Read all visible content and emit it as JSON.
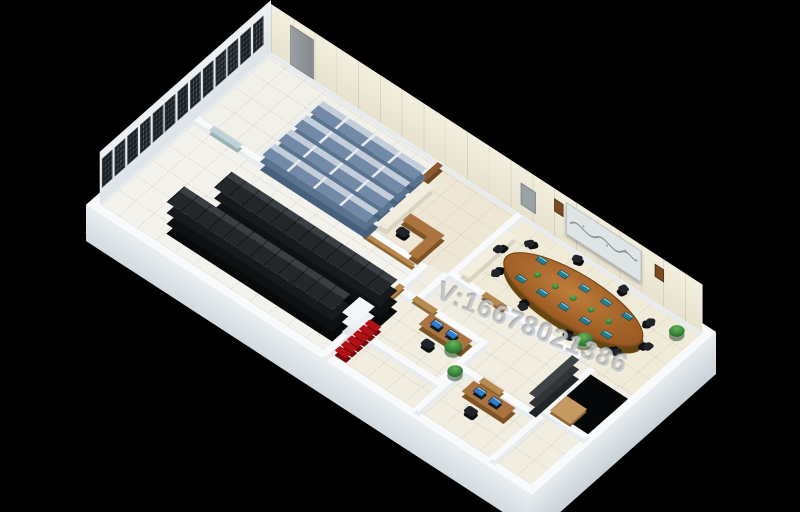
{
  "watermark": {
    "text": "V:16678021386"
  },
  "scene": {
    "type": "3d-isometric-floorplan-render",
    "subject": "data center machine room floor plan",
    "background_color": "#000000",
    "building": {
      "outer_wall_color": "#fbfcfd",
      "window_panels": 13,
      "window_color": "#262d33",
      "wall_display": "map-screen",
      "wall_speakers": 2
    },
    "rooms": [
      {
        "name": "archive-room",
        "floor_color": "#f1f0e9",
        "shelving_rows": 4,
        "shelving_units_per_row": 4,
        "shelving_front_color": "#7289a8",
        "shelving_top_color": "#c4cedb"
      },
      {
        "name": "server-room",
        "floor_color": "#f3f2ec",
        "rack_rows": 2,
        "rack_segments_per_row": 12,
        "rack_color": "#23272b",
        "pillar_color": "#f4f6f8"
      },
      {
        "name": "reception",
        "floor_color": "#efe7d6",
        "bench_color": "#a9743f"
      },
      {
        "name": "conference-room",
        "floor_color": "#f0ead9",
        "table_color": "#9a5a22",
        "chairs": 10,
        "tabletop_screens": 10,
        "table_plants": 5
      },
      {
        "name": "office-1",
        "floor_color": "#f1ede1",
        "monitors": 2
      },
      {
        "name": "office-2",
        "floor_color": "#f1ede1",
        "monitors": 2
      },
      {
        "name": "corridor",
        "red_chairs": 6,
        "plants": 4
      }
    ],
    "palette": {
      "monitor_screen": "#2d7fd0",
      "tabletop_screen": "#1e7f96",
      "plant_green": "#3e8f3f",
      "red_chair": "#b01218",
      "wood": "#a9743f",
      "threshold_tan": "#b98a4e",
      "glass_door": "#b9cfd4",
      "dark_panel_wall": "#3f4447"
    }
  }
}
